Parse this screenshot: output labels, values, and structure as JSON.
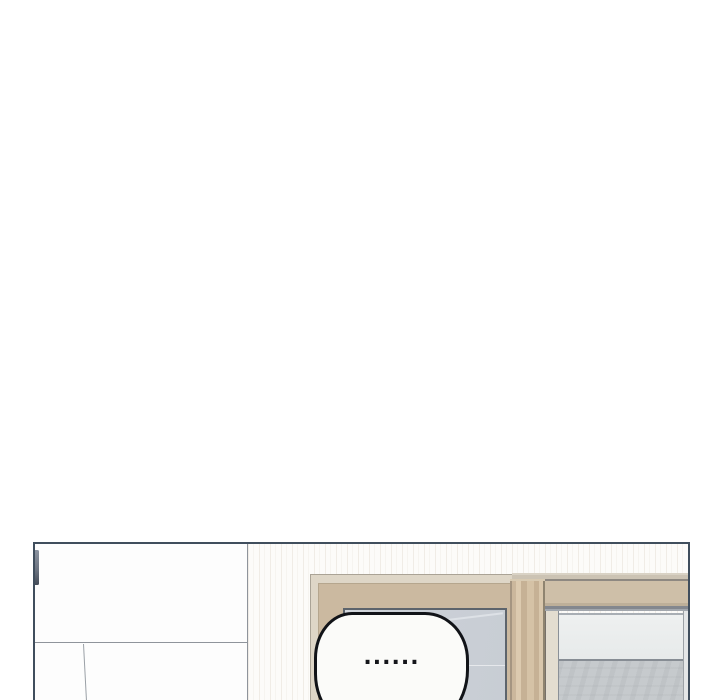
{
  "page": {
    "background": "#ffffff"
  },
  "panel": {
    "kind": "webtoon-comic-panel",
    "speech_bubble": {
      "text": "......"
    },
    "palette": {
      "panel_border": "#404e5d",
      "interior_line_gray": "#8f949b",
      "wood_frame": "#cbb9a0",
      "wood_post": "#d5c2a6",
      "door_glass": "#cbd0d7",
      "window_glass_upper": "#eceeee",
      "window_glass_lower": "#c6cacd",
      "wall": "#fcfbf9",
      "cabinet": "#fdfdfd",
      "bubble_fill": "#fbfbf9",
      "bubble_stroke": "#111318"
    }
  }
}
